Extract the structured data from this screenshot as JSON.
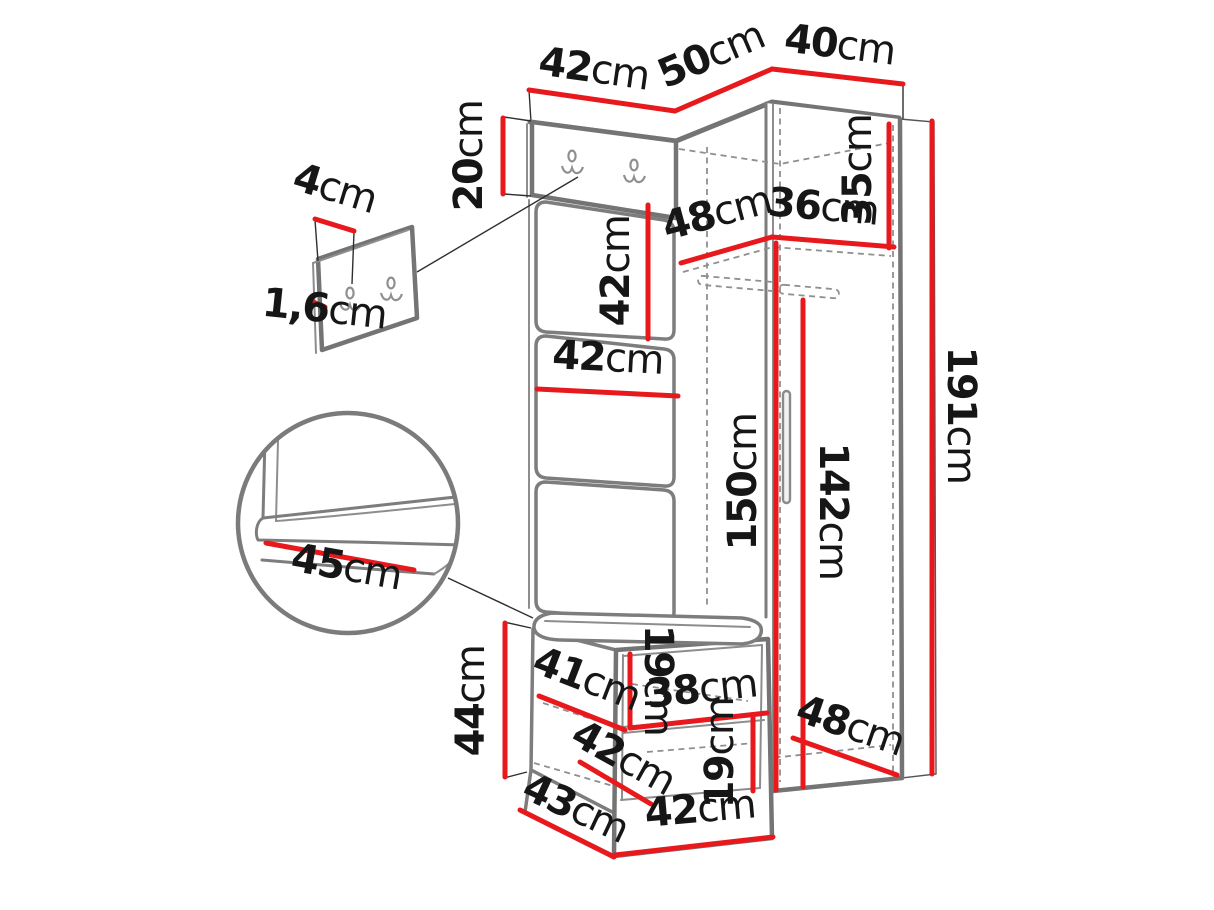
{
  "title": "Hallway furniture set dimension diagram",
  "colors": {
    "dimension_line": "#e8191d",
    "furniture_edge": "#747474",
    "label_text": "#161616"
  },
  "dimensions": {
    "top_width_left": {
      "num": "42",
      "unit": "cm"
    },
    "top_depth_corner": {
      "num": "50",
      "unit": "cm"
    },
    "top_width_right": {
      "num": "40",
      "unit": "cm"
    },
    "hook_panel_height": {
      "num": "20",
      "unit": "cm"
    },
    "mini_panel_depth": {
      "num": "4",
      "unit": "cm"
    },
    "mini_panel_thickness": {
      "num": "1,6",
      "unit": "cm"
    },
    "cushion_height": {
      "num": "42",
      "unit": "cm"
    },
    "cushion_width": {
      "num": "42",
      "unit": "cm"
    },
    "shelf_depth": {
      "num": "48",
      "unit": "cm"
    },
    "shelf_width": {
      "num": "36",
      "unit": "cm"
    },
    "top_section_height": {
      "num": "35",
      "unit": "cm"
    },
    "interior_height": {
      "num": "150",
      "unit": "cm"
    },
    "door_height": {
      "num": "142",
      "unit": "cm"
    },
    "total_height": {
      "num": "191",
      "unit": "cm"
    },
    "seat_depth_detail": {
      "num": "45",
      "unit": "cm"
    },
    "bench_height": {
      "num": "44",
      "unit": "cm"
    },
    "bench_shelf_depth": {
      "num": "41",
      "unit": "cm"
    },
    "bench_upper_gap": {
      "num": "19",
      "unit": "cm"
    },
    "bench_shelf_width": {
      "num": "38",
      "unit": "cm"
    },
    "bench_lower_depth": {
      "num": "42",
      "unit": "cm"
    },
    "bench_lower_gap": {
      "num": "19",
      "unit": "cm"
    },
    "bench_depth": {
      "num": "43",
      "unit": "cm"
    },
    "bench_width": {
      "num": "42",
      "unit": "cm"
    },
    "wardrobe_bottom_depth": {
      "num": "48",
      "unit": "cm"
    }
  }
}
